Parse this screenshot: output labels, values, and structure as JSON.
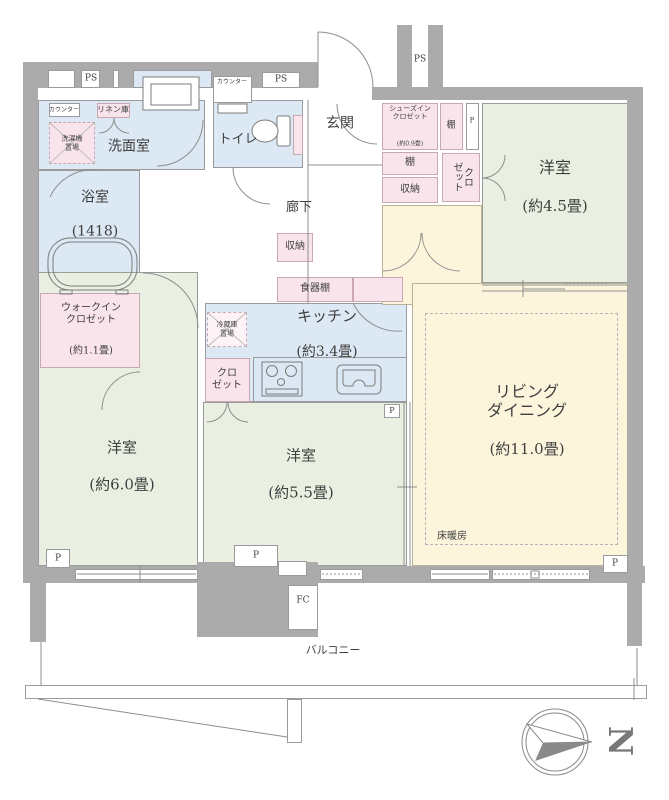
{
  "rooms": {
    "washroom": {
      "name": "洗面室"
    },
    "bath": {
      "name": "浴室",
      "size": "(1418)"
    },
    "toilet": {
      "name": "トイレ"
    },
    "entrance": {
      "name": "玄関"
    },
    "corridor": {
      "name": "廊下"
    },
    "shoes_in_closet": {
      "name": "シューズイン\nクロゼット",
      "size": "(約0.9畳)"
    },
    "western_4_5": {
      "name": "洋室",
      "size": "(約4.5畳)"
    },
    "living_dining": {
      "name": "リビング\nダイニング",
      "size": "(約11.0畳)"
    },
    "kitchen": {
      "name": "キッチン",
      "size": "(約3.4畳)"
    },
    "western_6_0": {
      "name": "洋室",
      "size": "(約6.0畳)"
    },
    "western_5_5": {
      "name": "洋室",
      "size": "(約5.5畳)"
    },
    "walk_in_closet": {
      "name": "ウォークイン\nクロゼット",
      "size": "(約1.1畳)"
    },
    "balcony": {
      "name": "バルコニー"
    }
  },
  "fixtures": {
    "linen": "リネン庫",
    "washer": "洗濯機\n置場",
    "counter_washroom": "カウンター",
    "counter_toilet": "カウンター",
    "shelf_top": "棚",
    "shelf_mid": "棚",
    "storage_hall": "収納",
    "storage_corridor": "収納",
    "closet_hall": "クロ\nゼット",
    "cupboard": "食器棚",
    "fridge": "冷蔵庫\n置場",
    "closet_kitchen": "クロ\nゼット",
    "floor_heating": "床暖房"
  },
  "markers": {
    "ps_left": "PS",
    "ps_mid": "PS",
    "ps_right": "PS",
    "p_shoes": "P",
    "p_kitchen": "P",
    "p_balcony_left": "P",
    "p_balcony_center": "P",
    "p_balcony_right": "P",
    "fc": "FC"
  },
  "compass": {
    "north": "N"
  },
  "colors": {
    "wall": "#ababab",
    "water": "#dce8f3",
    "room": "#e9f0e2",
    "living": "#fcf5dc",
    "closet": "#f9e4ec"
  }
}
